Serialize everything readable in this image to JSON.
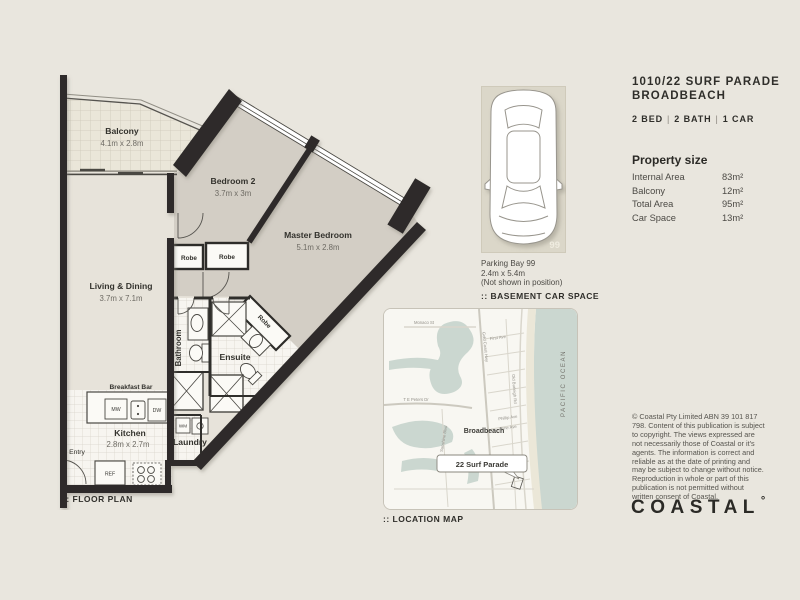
{
  "colors": {
    "background": "#e9e6de",
    "walls": "#2d2c29",
    "bedroom_fill": "#d3cec5",
    "living_fill": "#e7e3da",
    "water": "#cbd7d0",
    "ink": "#2f2e2a"
  },
  "listing": {
    "title_line1": "1010/22 SURF PARADE",
    "title_line2": "BROADBEACH",
    "specs": {
      "beds": "2 BED",
      "baths": "2 BATH",
      "cars": "1 CAR",
      "separator": "|"
    }
  },
  "property_size": {
    "heading": "Property size",
    "rows": [
      {
        "label": "Internal Area",
        "value": "83m²"
      },
      {
        "label": "Balcony",
        "value": "12m²"
      },
      {
        "label": "Total Area",
        "value": "95m²"
      },
      {
        "label": "Car Space",
        "value": "13m²"
      }
    ]
  },
  "parking": {
    "bay_number": "99",
    "caption_line1": "Parking Bay 99",
    "caption_line2": "2.4m x 5.4m",
    "caption_line3": "(Not shown in position)",
    "section_label": ":: BASEMENT CAR SPACE"
  },
  "floor_plan": {
    "section_label": ":: FLOOR PLAN",
    "rooms": {
      "balcony": {
        "name": "Balcony",
        "dims": "4.1m x 2.8m"
      },
      "bedroom2": {
        "name": "Bedroom 2",
        "dims": "3.7m x 3m"
      },
      "master": {
        "name": "Master Bedroom",
        "dims": "5.1m x 2.8m"
      },
      "living": {
        "name": "Living & Dining",
        "dims": "3.7m x 7.1m"
      },
      "kitchen": {
        "name": "Kitchen",
        "dims": "2.8m x 2.7m"
      },
      "bathroom": {
        "name": "Bathroom"
      },
      "ensuite": {
        "name": "Ensuite"
      },
      "laundry": {
        "name": "Laundry"
      },
      "entry": {
        "name": "Entry"
      },
      "robe1": {
        "name": "Robe"
      },
      "robe2": {
        "name": "Robe"
      },
      "robe3": {
        "name": "Robe"
      },
      "labels": {
        "breakfast_bar": "Breakfast Bar",
        "mw": "MW",
        "dw": "DW",
        "wm": "WM",
        "ref": "REF"
      }
    }
  },
  "location_map": {
    "section_label": ":: LOCATION MAP",
    "suburb_label": "Broadbeach",
    "pin_label": "22 Surf Parade",
    "ocean_label": "PACIFIC OCEAN",
    "streets": [
      "Monaco St",
      "First Ave",
      "T E Peters Dr",
      "Sunshine Blvd",
      "Gold Coast Hwy",
      "Old Burleigh Rd",
      "Phillip Ave",
      "Anne Ave"
    ]
  },
  "legal": {
    "disclaimer": "© Coastal Pty Limited ABN 39 101 817 798. Content of this publication is subject to copyright. The views expressed are not necessarily those of Coastal or it's agents. The information is correct and reliable as at the date of printing and may be subject to change without notice. Reproduction in whole or part of this publication is not permitted without written consent of Coastal."
  },
  "brand": {
    "logo_text": "COASTAL",
    "logo_mark": "°"
  }
}
